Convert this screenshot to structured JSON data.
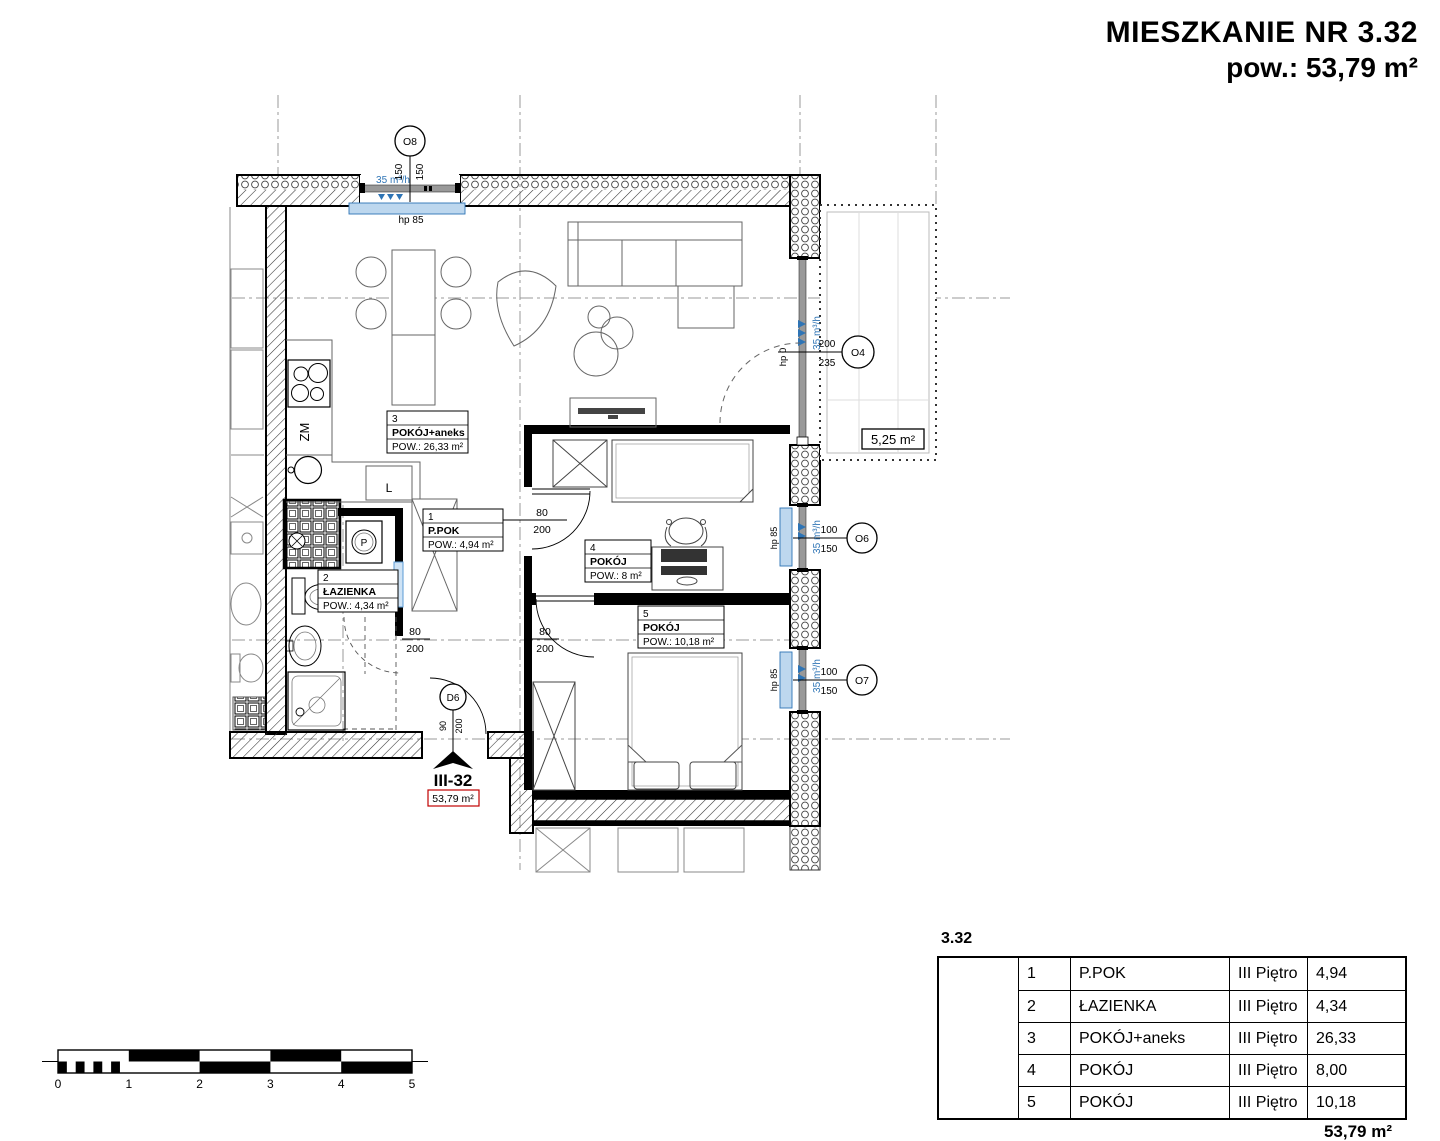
{
  "header": {
    "title": "MIESZKANIE NR 3.32",
    "area": "pow.: 53,79 m²"
  },
  "plan": {
    "rooms": [
      {
        "no": "1",
        "name": "P.POK",
        "area": "POW.: 4,94 m²"
      },
      {
        "no": "2",
        "name": "ŁAZIENKA",
        "area": "POW.: 4,34 m²"
      },
      {
        "no": "3",
        "name": "POKÓJ+aneks",
        "area": "POW.: 26,33 m²"
      },
      {
        "no": "4",
        "name": "POKÓJ",
        "area": "POW.: 8 m²"
      },
      {
        "no": "5",
        "name": "POKÓJ",
        "area": "POW.: 10,18 m²"
      }
    ],
    "openings": {
      "o8": {
        "id": "O8",
        "dim_a": "150",
        "dim_b": "150",
        "sill": "hp 85",
        "vent": "35 m³/h"
      },
      "o4": {
        "id": "O4",
        "dim_a": "200",
        "dim_b": "235",
        "sill": "hp 0",
        "vent": "35 m³/h"
      },
      "o6": {
        "id": "O6",
        "dim_a": "100",
        "dim_b": "150",
        "sill": "hp 85",
        "vent": "35 m³/h"
      },
      "o7": {
        "id": "O7",
        "dim_a": "100",
        "dim_b": "150",
        "sill": "hp 85",
        "vent": "35 m³/h"
      },
      "d6": {
        "id": "D6",
        "dim_a": "90",
        "dim_b": "200"
      }
    },
    "doors": {
      "room4": {
        "w": "80",
        "h": "200"
      },
      "room5": {
        "w": "80",
        "h": "200"
      },
      "bath": {
        "w": "80",
        "h": "200"
      }
    },
    "balcony": {
      "area": "5,25 m²"
    },
    "kitchen": {
      "dishwasher": "ZM",
      "fridge": "L",
      "washer": "P"
    },
    "entrance": {
      "unit": "III-32",
      "area": "53,79 m²"
    }
  },
  "scalebar": {
    "labels": [
      "0",
      "1",
      "2",
      "3",
      "4",
      "5"
    ]
  },
  "summary": {
    "unit": "3.32",
    "rows": [
      {
        "no": "1",
        "name": "P.POK",
        "floor": "III Piętro",
        "area": "4,94"
      },
      {
        "no": "2",
        "name": "ŁAZIENKA",
        "floor": "III Piętro",
        "area": "4,34"
      },
      {
        "no": "3",
        "name": "POKÓJ+aneks",
        "floor": "III Piętro",
        "area": "26,33"
      },
      {
        "no": "4",
        "name": "POKÓJ",
        "floor": "III Piętro",
        "area": "8,00"
      },
      {
        "no": "5",
        "name": "POKÓJ",
        "floor": "III Piętro",
        "area": "10,18"
      }
    ],
    "total": "53,79 m²"
  },
  "colors": {
    "accent_blue": "#2E74B5",
    "sill_fill": "#BDD7EE",
    "marker_red": "#C00000",
    "wall": "#000000"
  }
}
